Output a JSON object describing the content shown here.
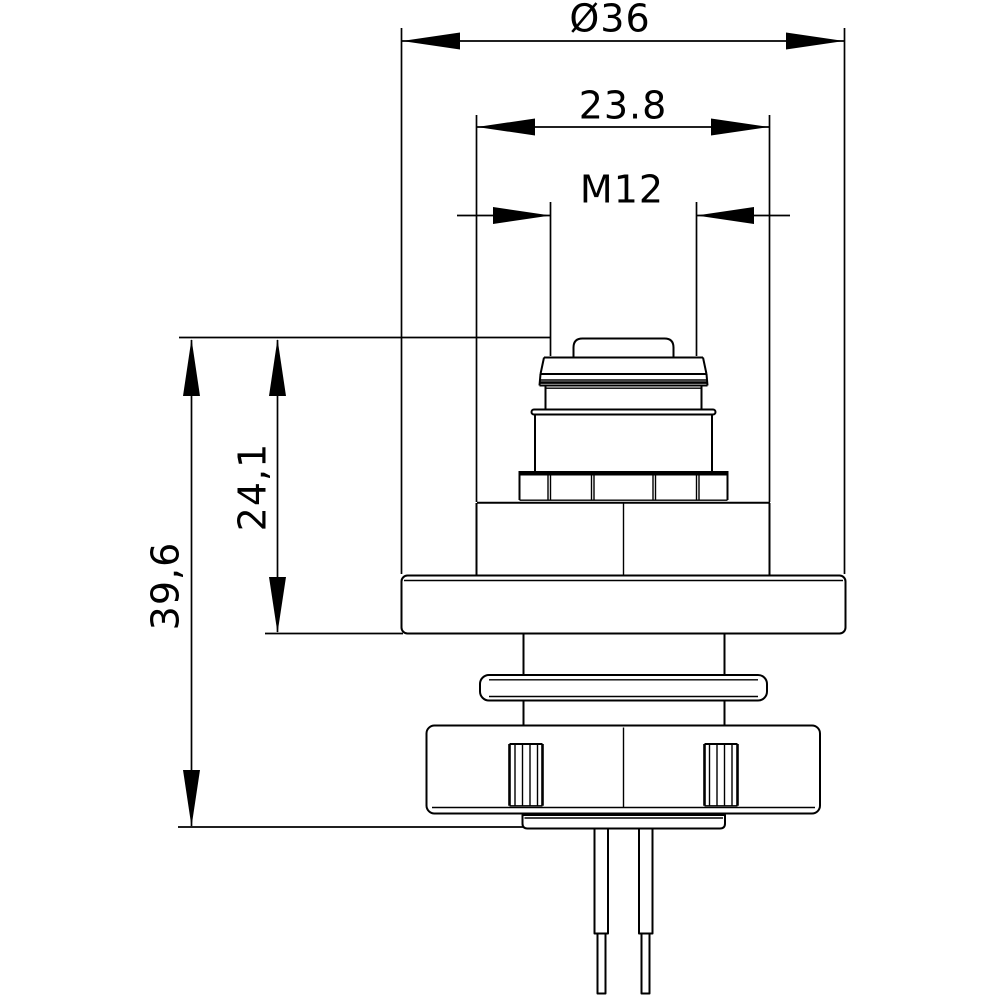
{
  "drawing": {
    "background_color": "#ffffff",
    "line_color": "#000000",
    "dimensions": {
      "outer_diameter": "Ø36",
      "head_diameter": "23.8",
      "thread_size": "M12",
      "upper_height": "24,1",
      "overall_height": "39,6"
    }
  }
}
